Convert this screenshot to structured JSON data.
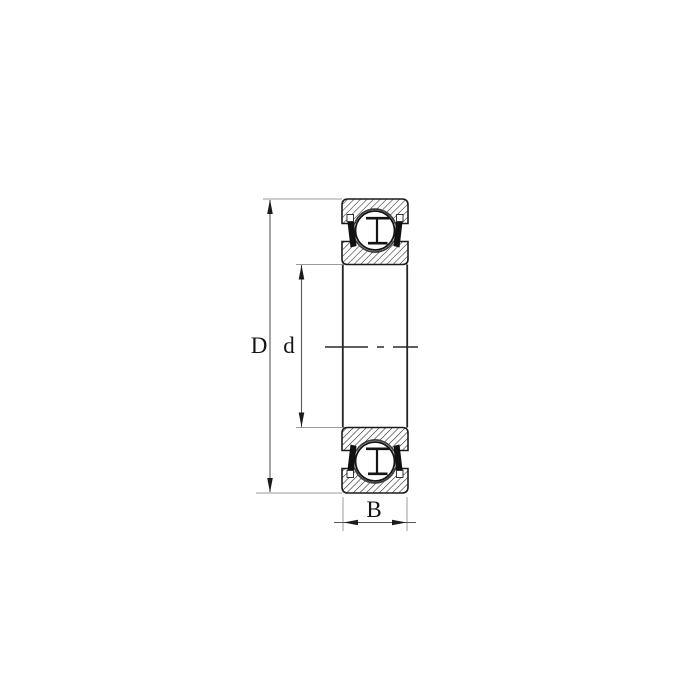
{
  "page": {
    "background": "#ffffff",
    "title": "Ball bearing cross-section technical drawing"
  },
  "drawing": {
    "subject": "deep-groove-ball-bearing-sealed-cross-section",
    "labels": {
      "outer_diameter": "D",
      "bore_diameter": "d",
      "width": "B"
    },
    "colors": {
      "outline": "#1b1b1b",
      "hatch": "#1b1b1b",
      "seal": "#101010",
      "ball_fill": "#ffffff",
      "dimension_line": "#5a5a5a",
      "extension_line": "#9b9b9b",
      "centerline": "#2a2a2a",
      "label_text": "#151515",
      "background": "#ffffff"
    }
  }
}
